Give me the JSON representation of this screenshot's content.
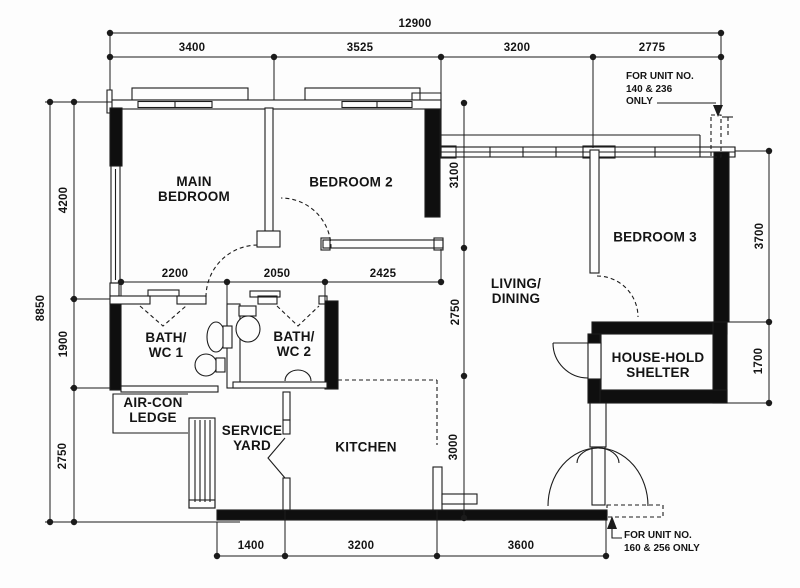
{
  "rooms": {
    "main_bedroom": "MAIN\nBEDROOM",
    "bedroom2": "BEDROOM 2",
    "bedroom3": "BEDROOM 3",
    "living_dining": "LIVING/\nDINING",
    "bath_wc1": "BATH/\nWC 1",
    "bath_wc2": "BATH/\nWC 2",
    "aircon_ledge": "AIR-CON\nLEDGE",
    "service_yard": "SERVICE\nYARD",
    "kitchen": "KITCHEN",
    "household_shelter": "HOUSE-HOLD\nSHELTER"
  },
  "dimensions": {
    "top_overall": "12900",
    "top_segments": [
      "3400",
      "3525",
      "3200",
      "2775"
    ],
    "left_overall": "8850",
    "left_segments": [
      "4200",
      "1900",
      "2750"
    ],
    "right_segments": [
      "3700",
      "1700"
    ],
    "inner_horizontal": [
      "2200",
      "2050",
      "2425"
    ],
    "inner_vertical": [
      "3100",
      "2750",
      "3000"
    ],
    "bottom_segments": [
      "1400",
      "3200",
      "3600"
    ]
  },
  "notes": {
    "top_right": "FOR  UNIT NO.\n140 & 236\nONLY",
    "bottom_right": "FOR  UNIT NO.\n160 & 256 ONLY"
  },
  "colors": {
    "line": "#1c1c1c",
    "wall_fill": "#0f0f0f",
    "background": "#fdfdfd"
  }
}
